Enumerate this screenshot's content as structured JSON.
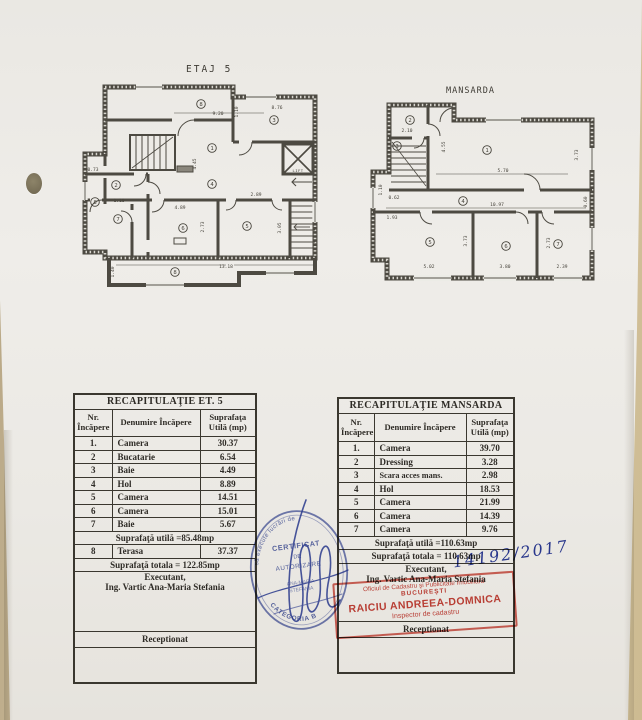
{
  "plans": [
    {
      "title": "ETAJ 5",
      "lift": "LIFT",
      "rooms": [
        "8",
        "3",
        "1",
        "2",
        "4",
        "8",
        "7",
        "6",
        "5",
        "8"
      ],
      "dims": [
        "9.20",
        "8.76",
        "1.10",
        "4.45",
        "2.89",
        "4.89",
        "2.73",
        "3.05",
        "13.18",
        "1.40",
        "0.73",
        "1.10"
      ]
    },
    {
      "title": "MANSARDA",
      "rooms": [
        "2",
        "3",
        "1",
        "4",
        "5",
        "6",
        "7"
      ],
      "dims": [
        "2.10",
        "4.55",
        "5.70",
        "3.73",
        "10.97",
        "0.62",
        "1.93",
        "3.73",
        "2.73",
        "5.02",
        "3.80",
        "2.39",
        "1.10",
        "0.60"
      ]
    }
  ],
  "tables": [
    {
      "title": "RECAPITULAŢIE ET. 5",
      "col_headers": [
        "Nr. Încăpere",
        "Denumire Încăpere",
        "Suprafaţa Utilă (mp)"
      ],
      "rows": [
        [
          "1.",
          "Camera",
          "30.37"
        ],
        [
          "2",
          "Bucatarie",
          "6.54"
        ],
        [
          "3",
          "Baie",
          "4.49"
        ],
        [
          "4",
          "Hol",
          "8.89"
        ],
        [
          "5",
          "Camera",
          "14.51"
        ],
        [
          "6",
          "Camera",
          "15.01"
        ],
        [
          "7",
          "Baie",
          "5.67"
        ]
      ],
      "utila_note": "Suprafaţă utilă =85.48mp",
      "extra_row": [
        "8",
        "Terasa",
        "37.37"
      ],
      "totala_note": "Suprafaţă totala = 122.85mp",
      "executant_label": "Executant,",
      "executant_name": "Ing. Vartic Ana-Maria Stefania",
      "receptionat_label": "Receptionat"
    },
    {
      "title": "RECAPITULAŢIE MANSARDA",
      "col_headers": [
        "Nr. Încăpere",
        "Denumire Încăpere",
        "Suprafaţa Utilă (mp)"
      ],
      "rows": [
        [
          "1.",
          "Camera",
          "39.70"
        ],
        [
          "2",
          "Dressing",
          "3.28"
        ],
        [
          "3",
          "Scara acces mans.",
          "2.98"
        ],
        [
          "4",
          "Hol",
          "18.53"
        ],
        [
          "5",
          "Camera",
          "21.99"
        ],
        [
          "6",
          "Camera",
          "14.39"
        ],
        [
          "7",
          "Camera",
          "9.76"
        ]
      ],
      "utila_note": "Suprafaţă utilă =110.63mp",
      "totala_note": "Suprafaţă totala = 110.63mp",
      "executant_label": "Executant,",
      "executant_name": "Ing. Vartic Ana-Maria Stefania",
      "receptionat_label": "Receptionat"
    }
  ],
  "annotations": {
    "handwritten": "14192/2017",
    "blue_stamp": {
      "arc_top": "să execute lucrări de",
      "l1": "CERTIFICAT",
      "l2": "DE",
      "l3": "AUTORIZARE",
      "l4": "ANA-MARIA",
      "l5": "STEFANIA",
      "arc_bottom": "CATEGORIA B"
    },
    "red_stamp": {
      "l1": "Oficiul de Cadastru şi Publicitate Imobiliară",
      "l2": "BUCUREŞTI",
      "l3": "RAICIU ANDREEA-DOMNICA",
      "l4": "Inspector de cadastru"
    }
  },
  "colors": {
    "stamp_blue": "#3a4ca0",
    "stamp_red": "#cc4238",
    "paper": "#ecebe6",
    "background": "#c9b893",
    "ink": "#35322c"
  }
}
